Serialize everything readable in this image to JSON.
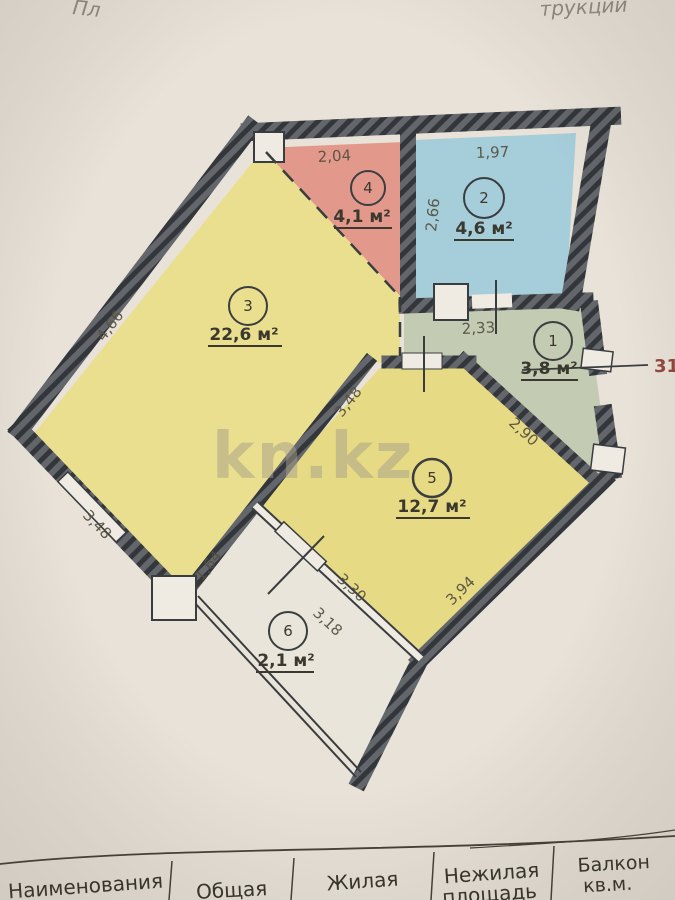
{
  "annotations": {
    "top_left": "Пл",
    "top_right": "трукции"
  },
  "watermark": "kn.kz",
  "apartment_number": "31",
  "rooms": [
    {
      "num": "1",
      "area": "3,8 м²"
    },
    {
      "num": "2",
      "area": "4,6 м²"
    },
    {
      "num": "3",
      "area": "22,6 м²"
    },
    {
      "num": "4",
      "area": "4,1 м²"
    },
    {
      "num": "5",
      "area": "12,7 м²"
    },
    {
      "num": "6",
      "area": "2,1 м²"
    }
  ],
  "dimensions": {
    "room4_top": "2,04",
    "room2_top": "1,97",
    "room2_left": "2,66",
    "room1_top": "2,33",
    "room3_left": "4,66",
    "room3_bottom": "3,48",
    "room5_left": "3,48",
    "room5_right": "2,90",
    "room5_bottom": "3,94",
    "balcony_window": "3,30",
    "balcony_inner": "3,18",
    "balcony_left": "1,64"
  },
  "table": {
    "headers": [
      {
        "line1": "Наименования",
        "line2": ""
      },
      {
        "line1": "Общая",
        "line2": ""
      },
      {
        "line1": "Жилая",
        "line2": ""
      },
      {
        "line1": "Нежилая",
        "line2": "площадь"
      },
      {
        "line1": "Балкон",
        "line2": "кв.м."
      }
    ]
  }
}
